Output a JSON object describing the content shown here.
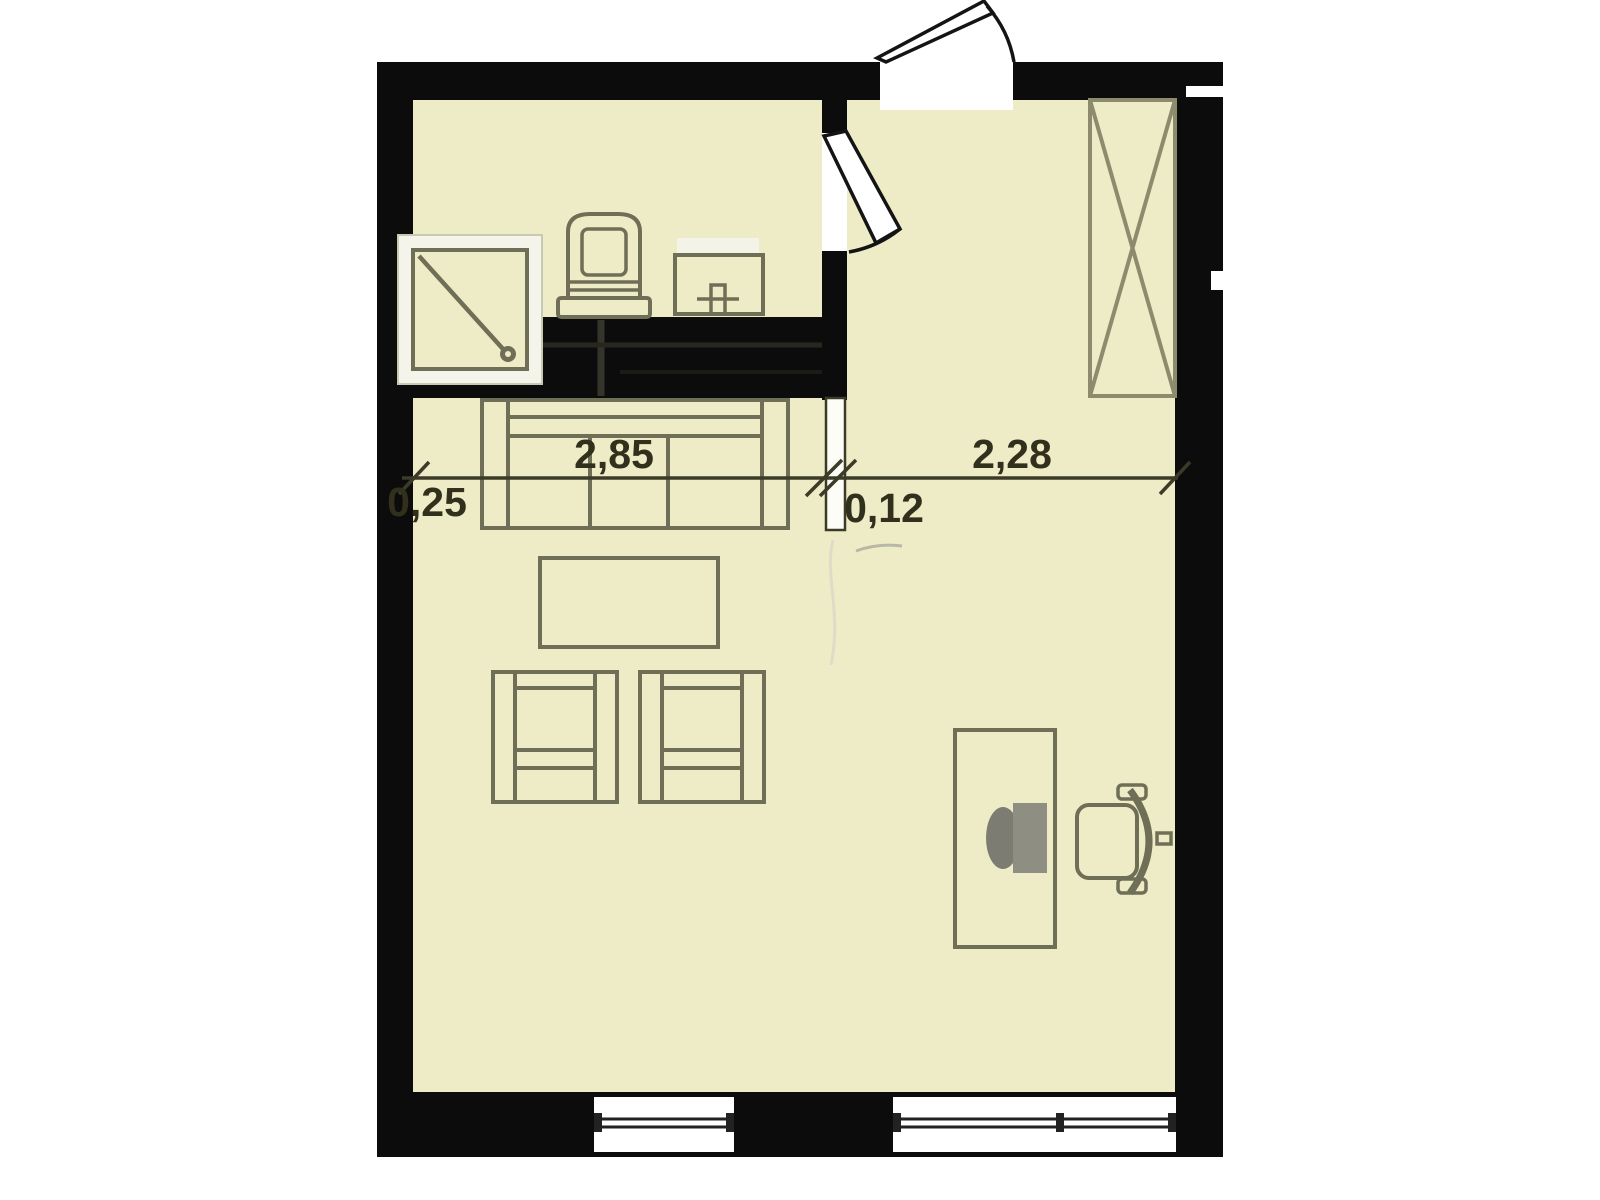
{
  "dimensions": {
    "segments": [
      {
        "name": "left-offset",
        "label": "0,25"
      },
      {
        "name": "living-room-width",
        "label": "2,85"
      },
      {
        "name": "partition-thickness",
        "label": "0,12"
      },
      {
        "name": "entry-hall-width",
        "label": "2,28"
      }
    ]
  },
  "furniture_icons": [
    "shower-icon",
    "toilet-icon",
    "sink-icon",
    "kitchen-counter-icon",
    "wardrobe-icon",
    "sofa-icon",
    "coffee-table-icon",
    "armchair-icon",
    "armchair-icon",
    "desk-icon",
    "monitor-icon",
    "office-chair-icon",
    "entrance-door-icon",
    "interior-door-icon",
    "window-icon",
    "window-icon"
  ],
  "colors": {
    "background": "#ffffff",
    "wall": "#0c0c0c",
    "floor": "#eeecc6",
    "furniture_line": "#6f6e56",
    "wardrobe_line": "#8c8b6d",
    "dimension_text": "#30301d",
    "shower_tray": "#f5f4ea",
    "monitor_fill": "#8f8e82"
  }
}
